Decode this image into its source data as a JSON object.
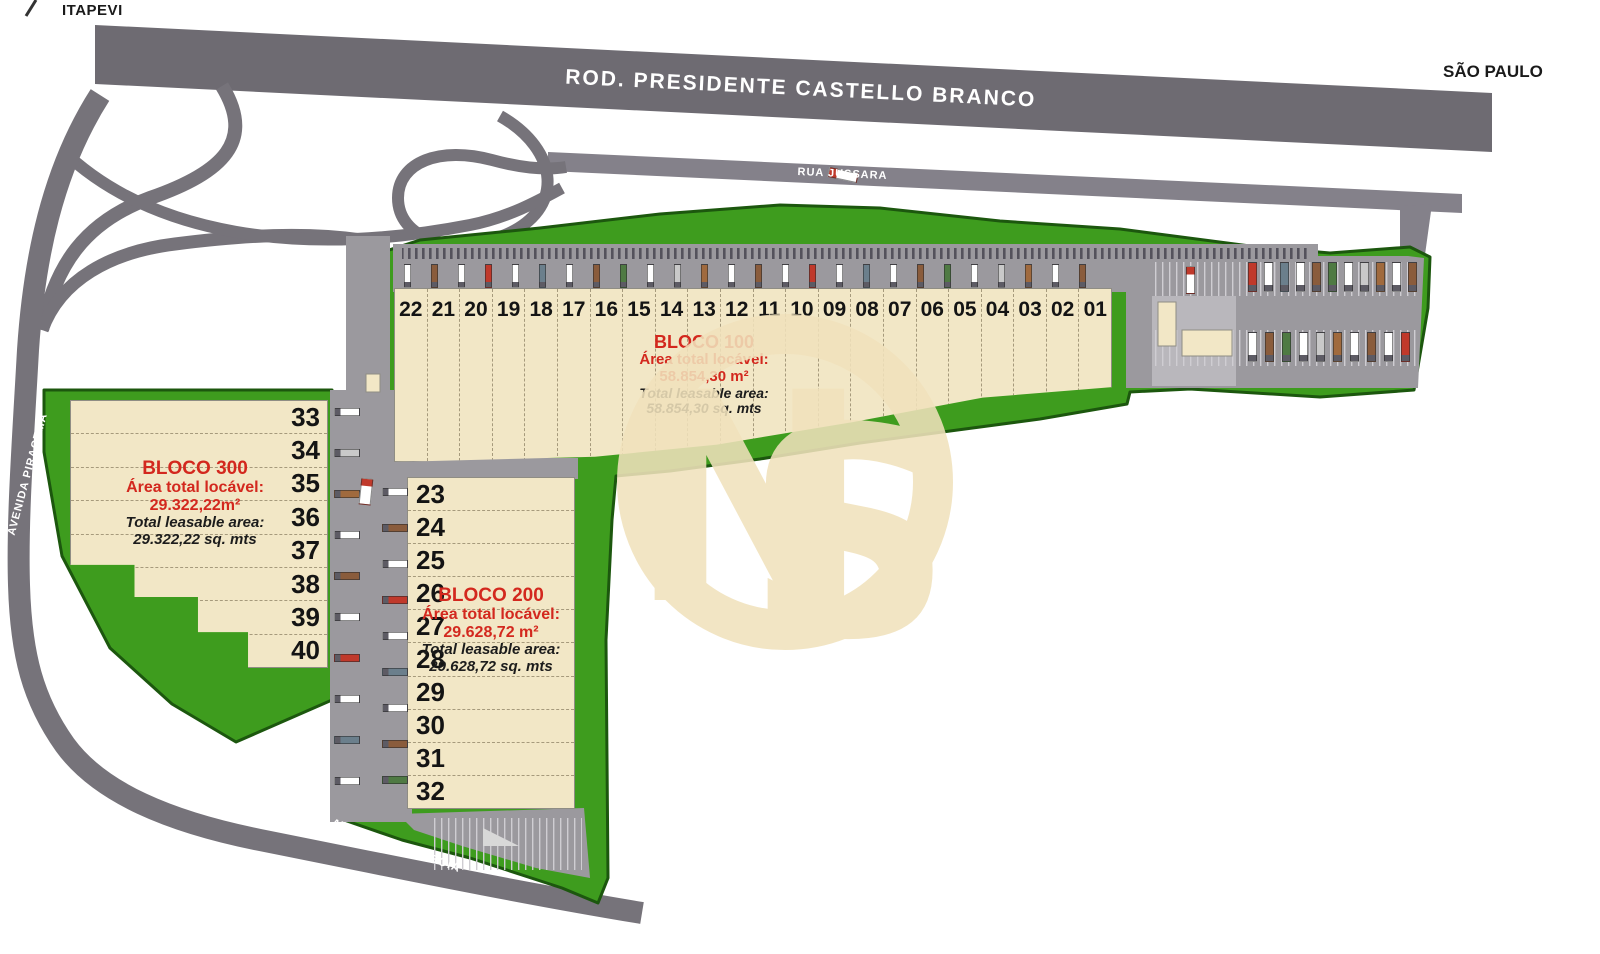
{
  "labels": {
    "itapevi": "ITAPEVI",
    "sao_paulo": "SÃO PAULO"
  },
  "roads": {
    "highway": "ROD.  PRESIDENTE CASTELLO BRANCO",
    "jussara": "RUA JUSSARA",
    "piracema": "AVENIDA PIRACEMA",
    "piramboia": "AVENIDA PIRAMBÓIA"
  },
  "blocks": {
    "bloco100": {
      "name": "BLOCO 100",
      "area_label": "Área total locável:",
      "area_value": "58.854,30 m²",
      "leasable_label": "Total leasable area:",
      "leasable_value": "58.854,30 sq. mts",
      "units": [
        "22",
        "21",
        "20",
        "19",
        "18",
        "17",
        "16",
        "15",
        "14",
        "13",
        "12",
        "11",
        "10",
        "09",
        "08",
        "07",
        "06",
        "05",
        "04",
        "03",
        "02",
        "01"
      ]
    },
    "bloco200": {
      "name": "BLOCO 200",
      "area_label": "Área total locável:",
      "area_value": "29.628,72 m²",
      "leasable_label": "Total leasable area:",
      "leasable_value": "29.628,72 sq. mts",
      "units": [
        "23",
        "24",
        "25",
        "26",
        "27",
        "28",
        "29",
        "30",
        "31",
        "32"
      ]
    },
    "bloco300": {
      "name": "BLOCO 300",
      "area_label": "Área total locável:",
      "area_value": "29.322,22m²",
      "leasable_label": "Total leasable area:",
      "leasable_value": "29.322,22 sq. mts",
      "units": [
        "33",
        "34",
        "35",
        "36",
        "37",
        "38",
        "39",
        "40"
      ]
    }
  },
  "watermark": {
    "monogram": "NS"
  },
  "colors": {
    "green": "#3e9c1e",
    "green_border": "#1c570e",
    "highway_gray": "#6e6b72",
    "road_gray": "#76737a",
    "pavement_gray": "#9b999e",
    "building_beige": "#f2e7c6",
    "label_red": "#d3281e",
    "watermark_beige": "#f1e2bc"
  },
  "decor": {
    "truck_palette": [
      "#ffffff",
      "#8a5c3c",
      "#ffffff",
      "#c0392b",
      "#ffffff",
      "#6b7f8c",
      "#ffffff",
      "#8a5c3c",
      "#4f7a43",
      "#ffffff",
      "#c9c9c9",
      "#a06a3e"
    ],
    "dock_rows": [
      {
        "name": "bloco100-docks",
        "x": 404,
        "y": 264,
        "dx": 27,
        "dy": 0,
        "count": 26,
        "w": 7,
        "h": 24,
        "dir": "v"
      },
      {
        "name": "yard-row-1",
        "x": 1248,
        "y": 262,
        "dx": 16,
        "dy": 0,
        "count": 11,
        "w": 9,
        "h": 30,
        "dir": "v"
      },
      {
        "name": "yard-row-2",
        "x": 1248,
        "y": 332,
        "dx": 17,
        "dy": 0,
        "count": 10,
        "w": 9,
        "h": 30,
        "dir": "v"
      },
      {
        "name": "bloco300-docks",
        "x": 334,
        "y": 408,
        "dx": 0,
        "dy": 41,
        "count": 10,
        "w": 26,
        "h": 8,
        "dir": "h"
      },
      {
        "name": "bloco200-docks",
        "x": 382,
        "y": 488,
        "dx": 0,
        "dy": 36,
        "count": 9,
        "w": 26,
        "h": 8,
        "dir": "h"
      }
    ],
    "loose_trucks": [
      {
        "x": 828,
        "y": 170,
        "w": 30,
        "h": 10,
        "angle": 12
      },
      {
        "x": 360,
        "y": 478,
        "w": 12,
        "h": 27,
        "angle": 6
      },
      {
        "x": 1186,
        "y": 266,
        "w": 9,
        "h": 28,
        "angle": 0
      }
    ]
  }
}
